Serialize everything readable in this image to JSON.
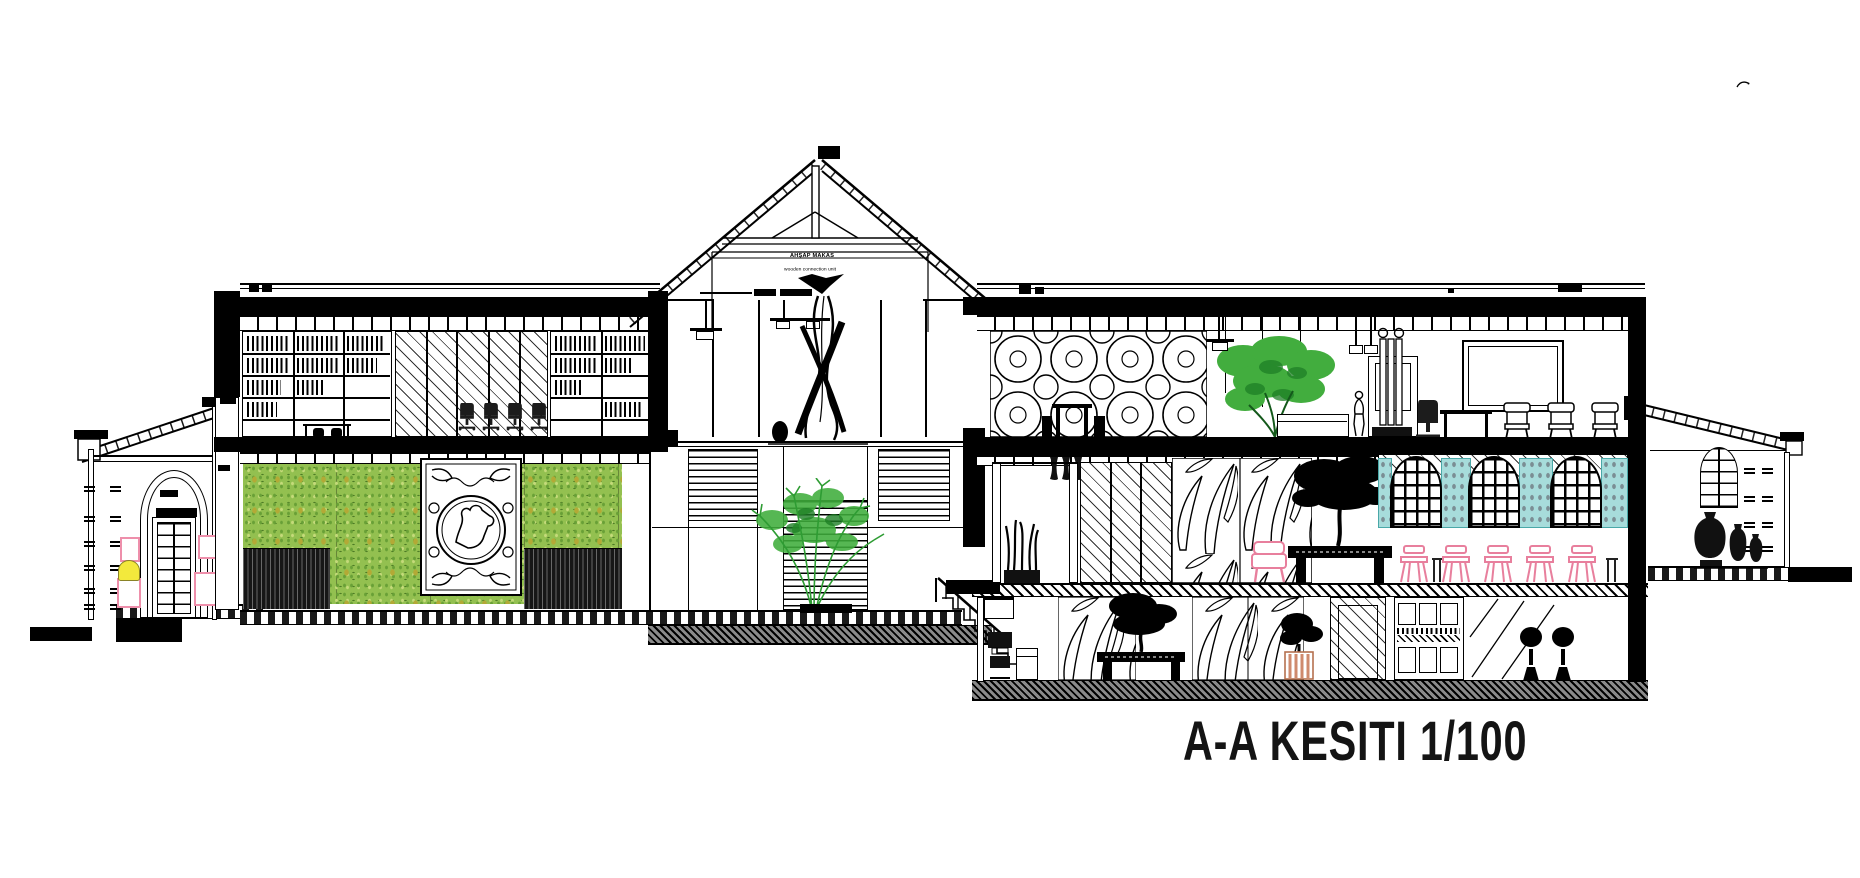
{
  "title": {
    "text": "A-A KESITI 1/100"
  },
  "drawing": {
    "section_mark": "A-A",
    "scale": "1/100",
    "type": "building-section"
  },
  "annotations": {
    "truss_label_primary": "AHŞAP MAKAS",
    "truss_label_secondary": "wooden connection unit"
  },
  "palette": {
    "line": "#000000",
    "green_wall": "#93c050",
    "green_wall_olive": "#b3a936",
    "foliage": "#42ad3e",
    "foliage_dark": "#1e7f26",
    "cyan_glass": "#a7dcdb",
    "pink_accent": "#ee8fab",
    "yellow_accent": "#f3e93c"
  },
  "icon_names": [
    "tree-icon",
    "bonsai-icon",
    "person-icon",
    "chair-icon",
    "urn-icon",
    "lamp-icon",
    "stair-icon",
    "sculpture-icon"
  ]
}
